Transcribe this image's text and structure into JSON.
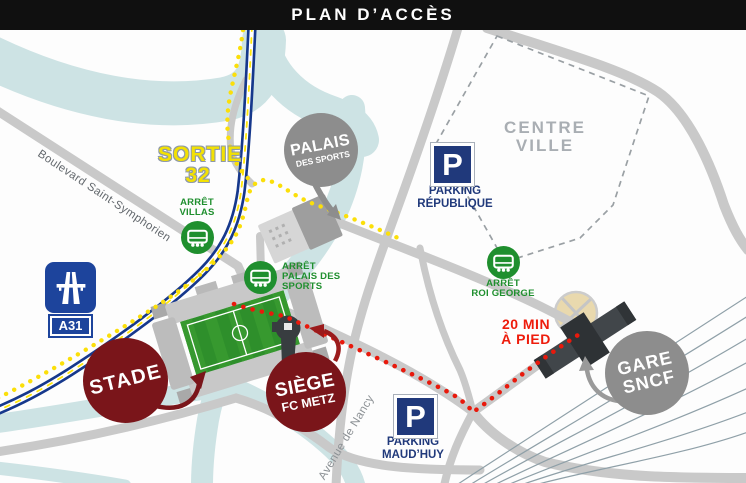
{
  "header": {
    "title": "PLAN D’ACCÈS"
  },
  "exit_sign": {
    "line1": "SORTIE",
    "line2": "32"
  },
  "highway_sign": {
    "label": "A31",
    "icon": "motorway-icon"
  },
  "roads": {
    "boulevard": "Boulevard Saint-Symphorien",
    "avenue": "Avenue de Nancy"
  },
  "districts": {
    "centre_ville_line1": "CENTRE",
    "centre_ville_line2": "VILLE"
  },
  "walk_note": {
    "line1": "20 MIN",
    "line2": "À PIED"
  },
  "bus_stops": {
    "villas": {
      "line1": "ARRÊT",
      "line2": "VILLAS",
      "icon": "bus-icon"
    },
    "palais": {
      "line1": "ARRÊT",
      "line2": "PALAIS DES",
      "line3": "SPORTS",
      "icon": "bus-icon"
    },
    "roi_george": {
      "line1": "ARRÊT",
      "line2": "ROI GEORGE",
      "icon": "bus-icon"
    }
  },
  "parkings": {
    "republique": {
      "p": "P",
      "line1": "PARKING",
      "line2": "RÉPUBLIQUE"
    },
    "maudhuy": {
      "p": "P",
      "line1": "PARKING",
      "line2": "MAUD’HUY"
    }
  },
  "pois": {
    "stade": {
      "label": "STADE"
    },
    "siege": {
      "line1": "SIÈGE",
      "line2": "FC METZ"
    },
    "palais": {
      "line1": "PALAIS",
      "line2": "DES SPORTS"
    },
    "gare": {
      "line1": "GARE",
      "line2": "SNCF"
    }
  },
  "legend_colors": {
    "header_bg": "#101010",
    "river": "#cde3e4",
    "road": "#c9c9c9",
    "highway_blue": "#16388c",
    "highway_dash_yellow": "#ffe60a",
    "bus_route_yellow": "#fbdf0a",
    "walk_route_red": "#e8190c",
    "bus_green": "#1f8f2e",
    "parking_navy": "#20397b",
    "club_maroon": "#7a151a",
    "poi_gray": "#8d8d8d"
  }
}
